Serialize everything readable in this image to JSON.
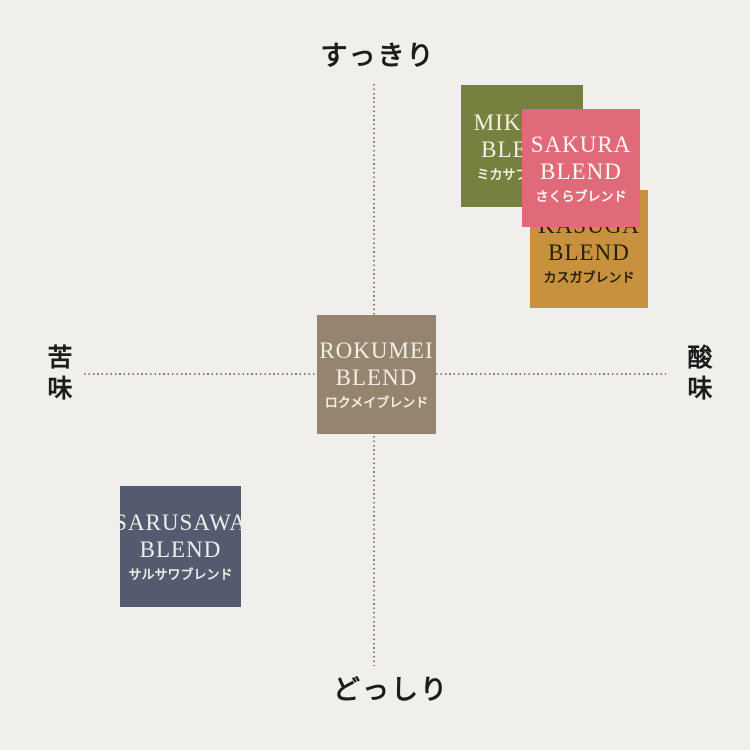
{
  "page": {
    "background_color": "#f1efeb",
    "description_labels": {
      "axis_top": "すっきり",
      "axis_bottom": "どっしり",
      "axis_left": "苦味",
      "axis_right": "酸味"
    }
  },
  "chart_data": {
    "type": "scatter",
    "subtype": "quadrant-taste-map",
    "grid": "dotted-crosshair",
    "axis_line_color": "#8d8077",
    "x_axis": {
      "negative_label": "苦味",
      "positive_label": "酸味",
      "range": [
        -1,
        1
      ]
    },
    "y_axis": {
      "negative_label": "どっしり",
      "positive_label": "すっきり",
      "range": [
        -1,
        1
      ]
    },
    "points": [
      {
        "name": "MIKASA",
        "blend_word": "BLEND",
        "name_ja": "ミカサブレンド",
        "x": 0.51,
        "y": 0.79,
        "color": "#76813f",
        "text_color": "#f2efe3",
        "pos": {
          "left": 461,
          "top": 85,
          "size": 122,
          "z": 1
        }
      },
      {
        "name": "KASUGA",
        "blend_word": "BLEND",
        "name_ja": "カスガブレンド",
        "x": 0.74,
        "y": 0.43,
        "color": "#c8913d",
        "text_color": "#25200f",
        "pos": {
          "left": 530,
          "top": 190,
          "size": 118,
          "z": 2
        }
      },
      {
        "name": "SAKURA",
        "blend_word": "BLEND",
        "name_ja": "さくらブレンド",
        "x": 0.71,
        "y": 0.71,
        "color": "#e06a7a",
        "text_color": "#fdfaf6",
        "pos": {
          "left": 522,
          "top": 109,
          "size": 118,
          "z": 3
        }
      },
      {
        "name": "ROKUMEI",
        "blend_word": "BLEND",
        "name_ja": "ロクメイブレンド",
        "x": 0,
        "y": 0,
        "color": "#95846f",
        "text_color": "#f2ede3",
        "pos": {
          "left": 317,
          "top": 315,
          "size": 119,
          "z": 1
        }
      },
      {
        "name": "SARUSAWA",
        "blend_word": "BLEND",
        "name_ja": "サルサワブレンド",
        "x": -0.67,
        "y": -0.59,
        "color": "#555b6e",
        "text_color": "#efedea",
        "pos": {
          "left": 120,
          "top": 486,
          "size": 121,
          "z": 1
        }
      }
    ]
  }
}
